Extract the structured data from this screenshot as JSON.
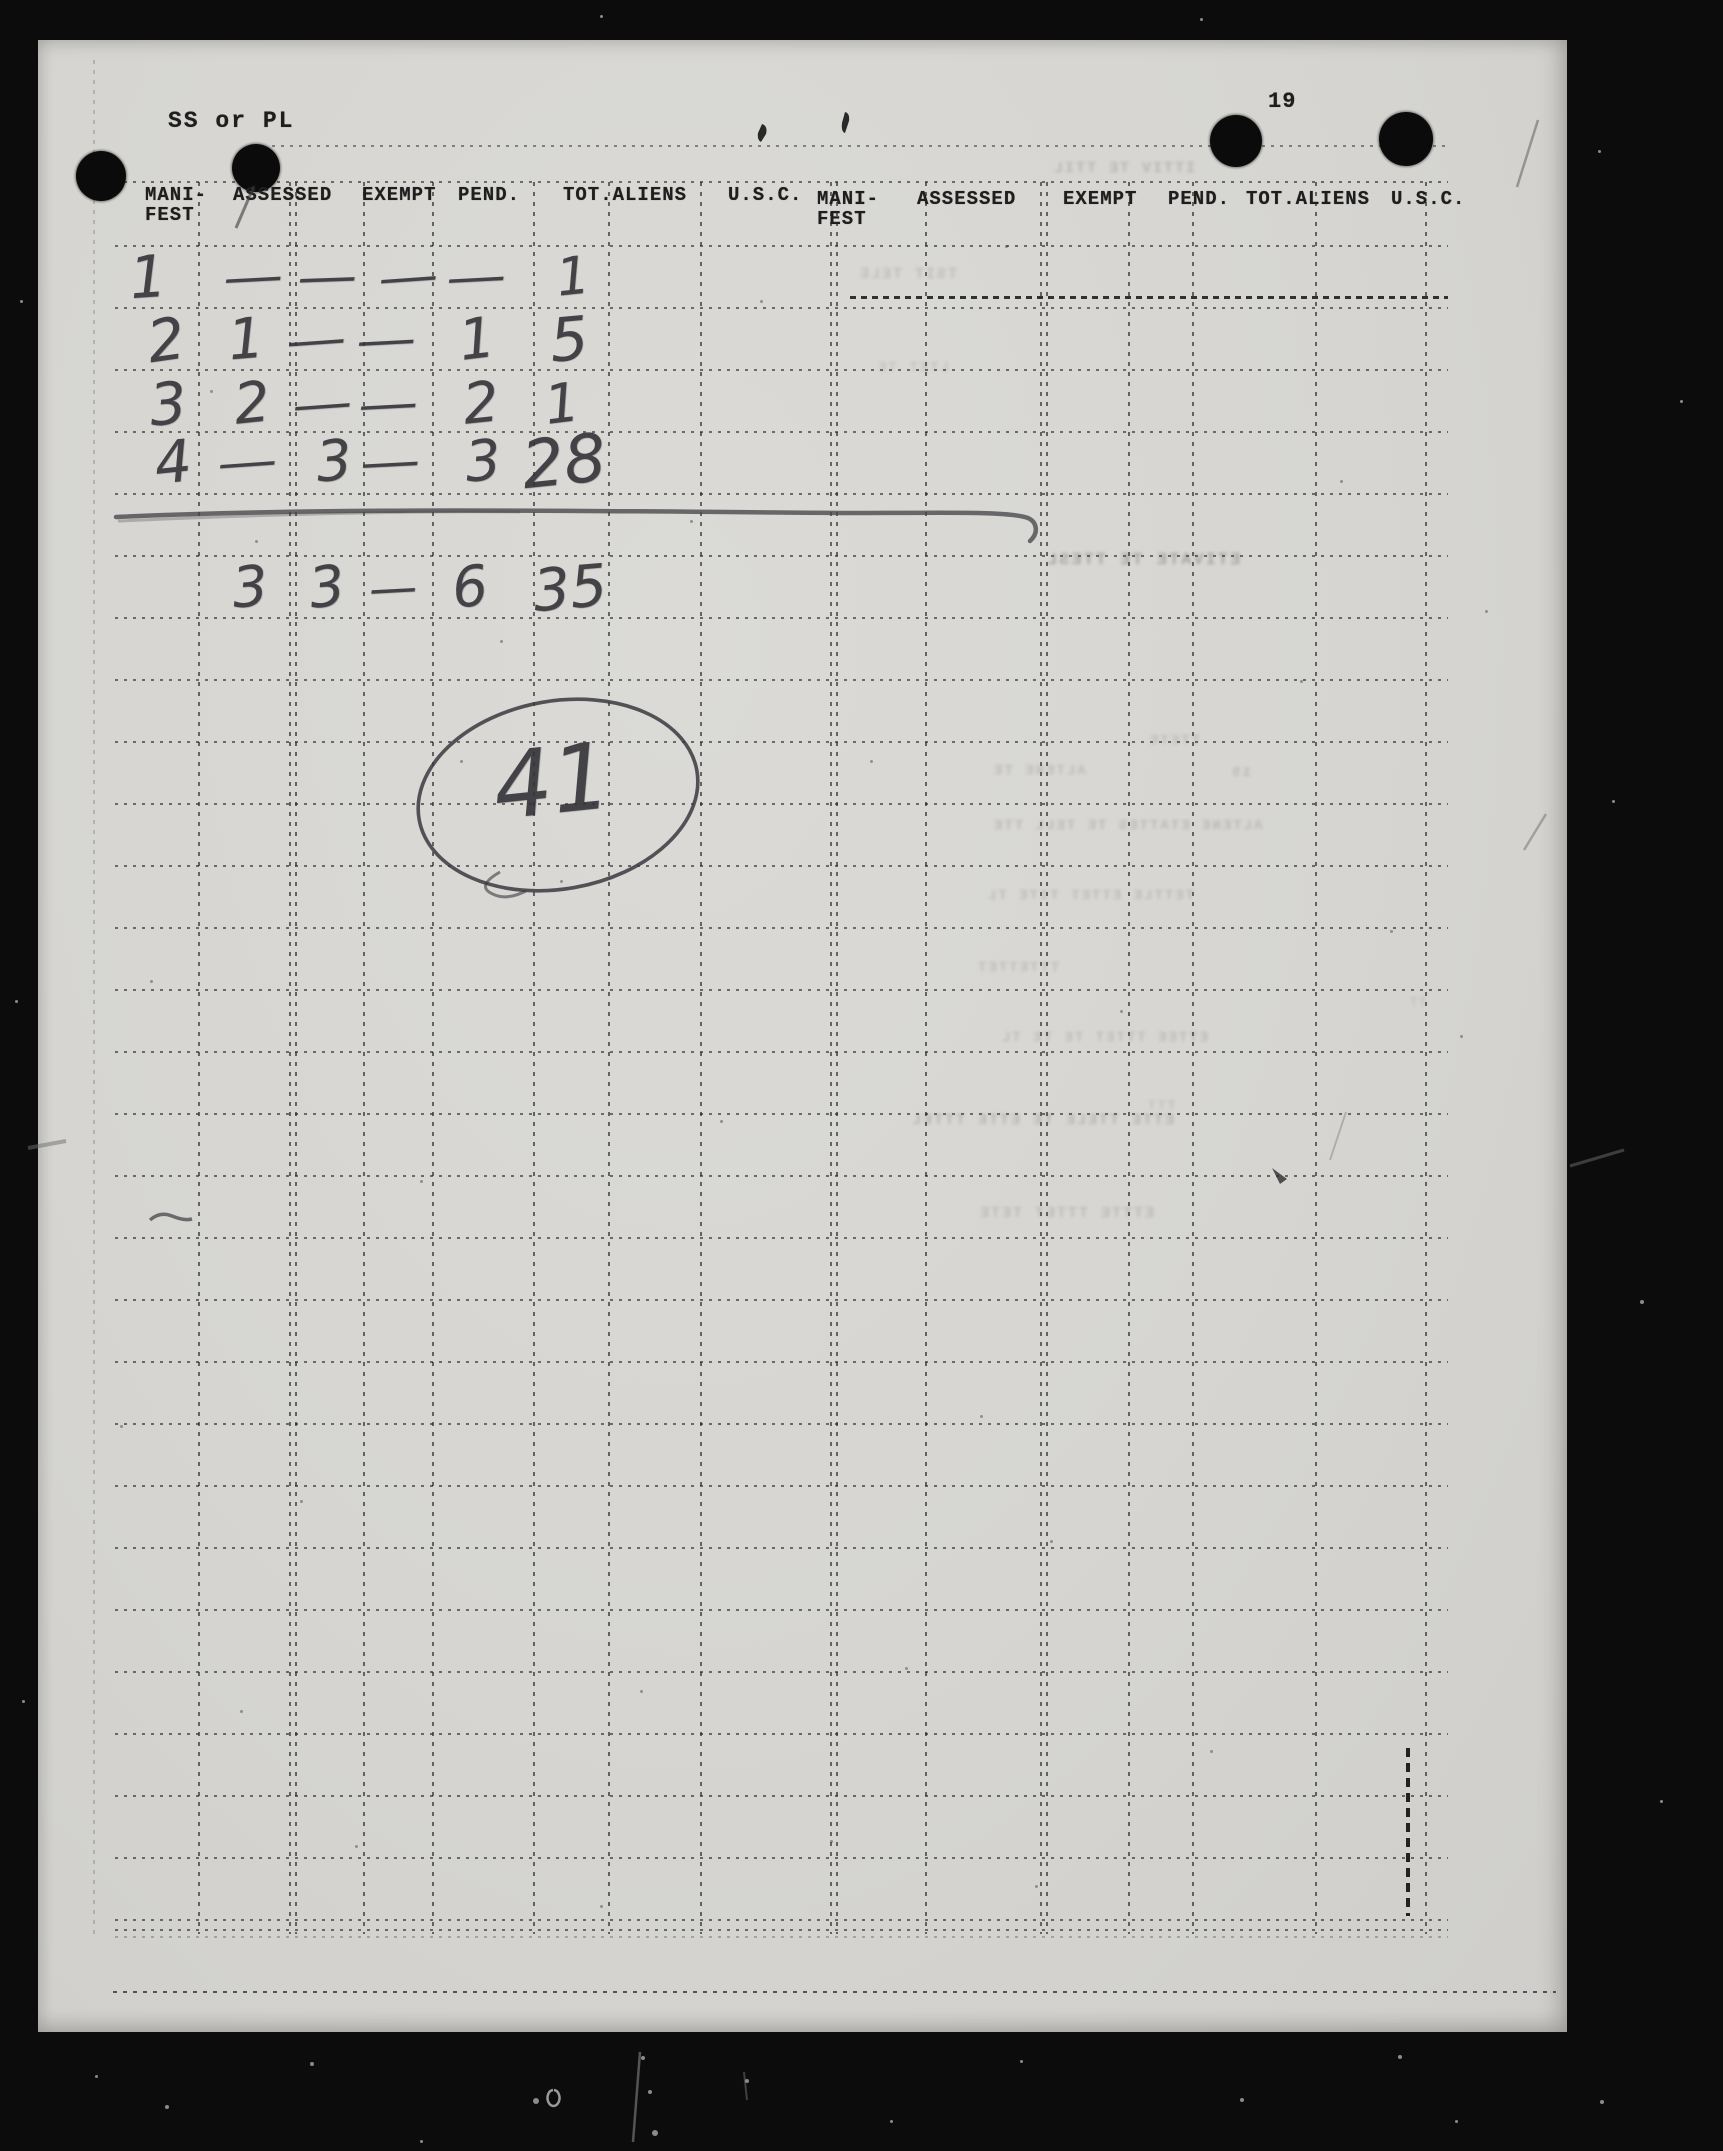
{
  "document": {
    "corner_label": "SS or PL",
    "page_number": "19"
  },
  "table": {
    "column_headers": [
      "MANI-FEST",
      "ASSESSED",
      "EXEMPT",
      "PEND.",
      "TOT.ALIENS",
      "U.S.C."
    ],
    "header_repeated_twice": true,
    "rows": [
      {
        "manifest": "1",
        "assessed": "—",
        "exempt": "—",
        "pend": "—",
        "tot_aliens": "—",
        "usc": "1"
      },
      {
        "manifest": "2",
        "assessed": "1",
        "exempt": "—",
        "pend": "—",
        "tot_aliens": "1",
        "usc": "5"
      },
      {
        "manifest": "3",
        "assessed": "2",
        "exempt": "—",
        "pend": "—",
        "tot_aliens": "2",
        "usc": "1"
      },
      {
        "manifest": "4",
        "assessed": "—",
        "exempt": "3",
        "pend": "—",
        "tot_aliens": "3",
        "usc": "28"
      }
    ],
    "totals_row": {
      "assessed": "3",
      "exempt": "3",
      "pend": "—",
      "tot_aliens": "6",
      "usc": "35"
    },
    "grand_total_circled": "41"
  },
  "annotations": {
    "ghost_lines": [
      "ITTIV TE TTIL",
      "TSIT TELE",
      "LTET TE",
      "ETIVATE TE TTESL",
      "TTETE",
      "ALTENE TE",
      "15",
      "ALTENE ETATTES TE TELL TTE",
      "TETTLE ETTET TITE TL",
      "TTTETTET",
      "ETTEE TTTET TE TE TL",
      "TTT",
      "ETTE TTELE TE ETTE TTTEL",
      "ETTTE TTTET TETE",
      "TT"
    ]
  },
  "colors": {
    "paper": "#d7d6d2",
    "film_black": "#0c0c0c",
    "typed_ink": "#1e1e1e",
    "pencil": "#3a3a3e"
  }
}
